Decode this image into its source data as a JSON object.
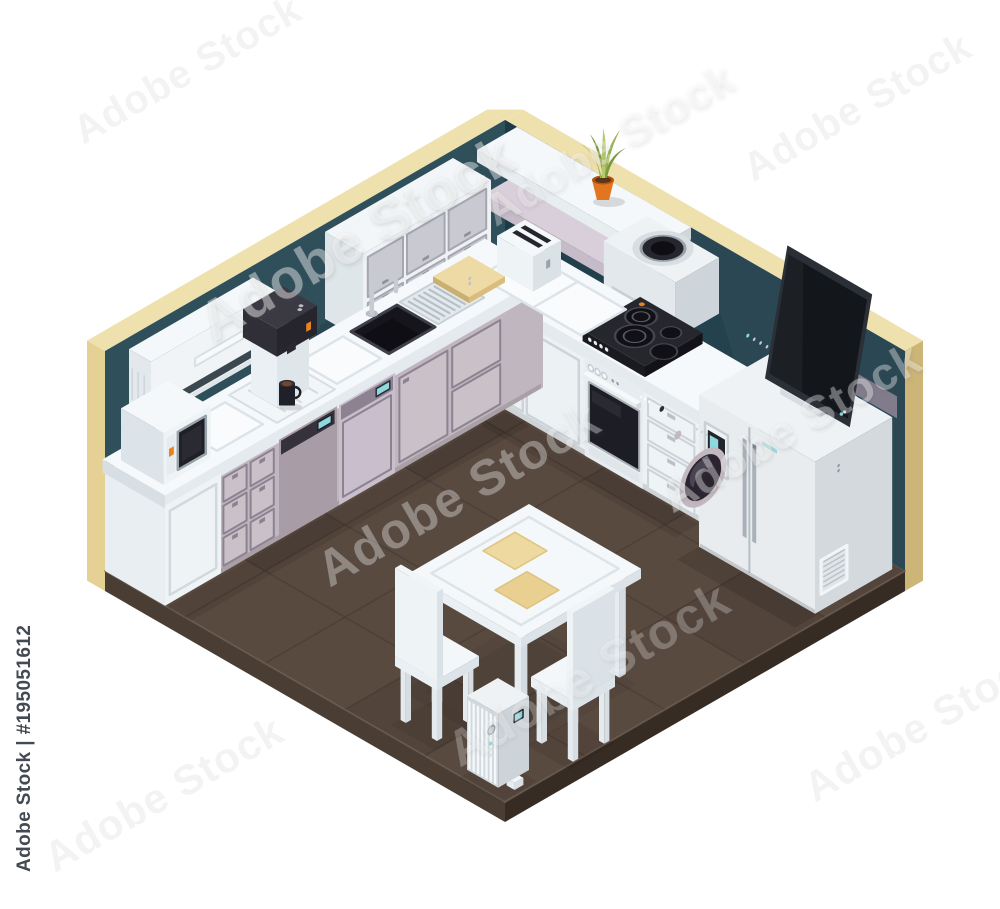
{
  "page": {
    "width": 1000,
    "height": 909,
    "background": "#ffffff"
  },
  "watermark": {
    "sidebar_text": "Adobe Stock | #195051612",
    "ghost_text": "Adobe Stock"
  },
  "scene_objects": [
    "left-wall",
    "right-wall",
    "wall-trim",
    "floor",
    "air-conditioner",
    "upper-cabinets",
    "base-cabinets-left",
    "kitchen-sink",
    "faucet",
    "drainboard",
    "cutting-board",
    "coffee-machine",
    "coffee-mug",
    "washing-machine",
    "dishwasher",
    "microwave",
    "toaster",
    "base-cabinets-right",
    "oven",
    "cooktop",
    "cooker-hood",
    "wall-shelf-upper",
    "wall-shelf-lower",
    "potted-plant",
    "refrigerator",
    "fridge-display",
    "television",
    "dining-table",
    "placemat",
    "chair",
    "oil-heater"
  ],
  "palette": {
    "wall_left": "#2f4f5b",
    "wall_right": "#2a4753",
    "wall_shadow": "#22404c",
    "wall_shadow_deep": "#1c3945",
    "trim_top": "#efe1ae",
    "trim_face": "#e6d194",
    "trim_side": "#cdb577",
    "floor_top": "#594a40",
    "floor_grid": "#4a3d34",
    "floor_side_left": "#4a3e34",
    "floor_side_right": "#362c24",
    "counter_top": "#f6f9fb",
    "counter_edge": "#e4eaee",
    "counter_side": "#d8dfe4",
    "white_front": "#ecf1f4",
    "white_side": "#dde4e9",
    "white_top": "#f4f8fa",
    "outline_soft": "#ccd4d9",
    "mauve_front": "#c0b6bf",
    "mauve_panel": "#c9c0c8",
    "mauve_side": "#aba0ab",
    "mauve_outline": "#8d8290",
    "washer_front": "#a89da6",
    "dark_appliance": "#34333c",
    "darker_appliance": "#24232b",
    "glass_black": "#17171e",
    "screen_teal": "#8fd8de",
    "accent_orange": "#e8821f",
    "steel": "#c3c9ce",
    "fridge_front": "#e8ecef",
    "fridge_side": "#d3d9dd",
    "tv_frame": "#2b2f36",
    "tv_screen": "#13161b",
    "plant_dark": "#7a9a3e",
    "plant_mid": "#9ab454",
    "plant_light": "#b6ca6c",
    "pot_orange": "#e2761e",
    "pot_rim": "#b5540f",
    "board_top": "#eedaa4",
    "board_side": "#d9bd7c",
    "coffee_brown": "#7a4526",
    "watermark_dark": "#434a52"
  }
}
